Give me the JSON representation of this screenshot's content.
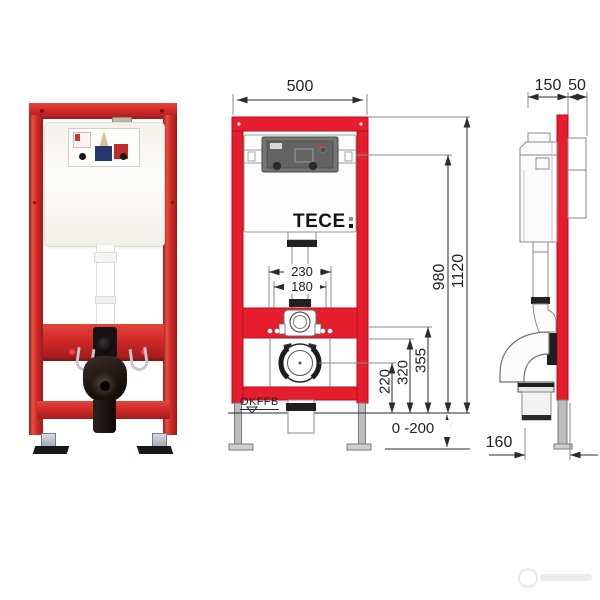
{
  "front_view": {
    "frame_width": "500",
    "flush_pipe_spacing": "230",
    "fixing_bolt_spacing": "180",
    "logo_text": "TECE",
    "floor_level_label": "OKFFB",
    "outlet_height": "220",
    "bend_height": "320",
    "bracket_height": "355",
    "cistern_height": "980",
    "total_height": "1120",
    "feet_adjust_range": "0 -200"
  },
  "side_view": {
    "frame_depth": "150",
    "wall_offset": "50",
    "outlet_depth": "160"
  },
  "colors": {
    "photo_frame_red": "#d22a28",
    "drawing_red": "#e51d2c",
    "dimension_line": "#2b2b2b",
    "extension_line_gray": "#8a8a8a"
  }
}
